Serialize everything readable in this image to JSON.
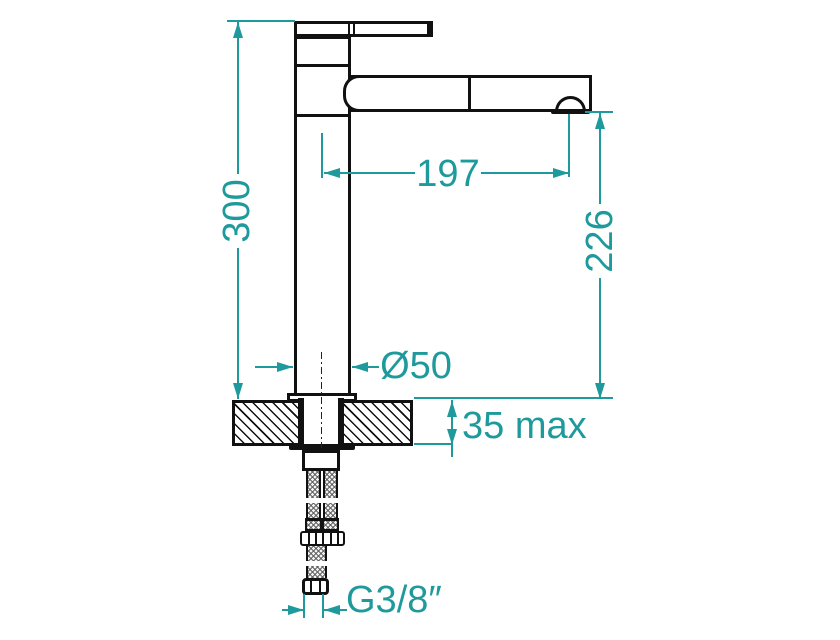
{
  "drawing": {
    "type": "technical-dimension-drawing",
    "subject": "Tall single-lever basin mixer faucet, side elevation with countertop cross-section and flexible supply hoses",
    "colors": {
      "dimension_accent": "#1f9a9c",
      "outline": "#111111",
      "background": "#ffffff"
    },
    "labels": {
      "overall_height": "300",
      "spout_reach": "197",
      "spout_outlet_height": "226",
      "body_diameter": "Ø50",
      "deck_thickness": "35 max",
      "supply_connection": "G3/8″"
    }
  }
}
